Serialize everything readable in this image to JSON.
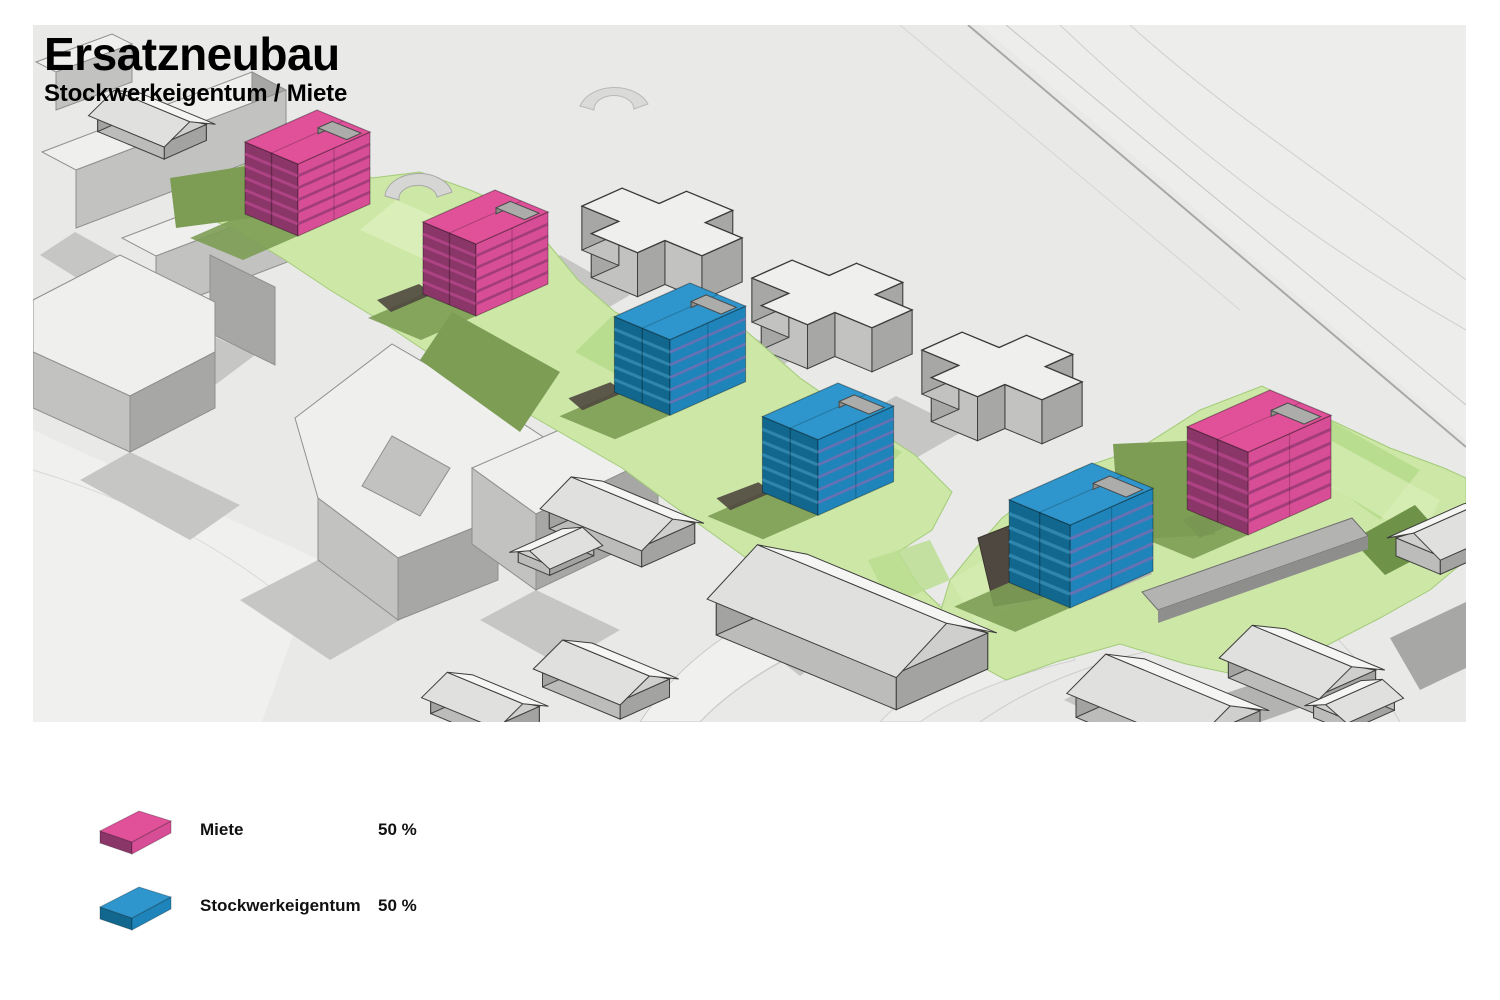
{
  "title": "Ersatzneubau",
  "subtitle": "Stockwerkeigentum / Miete",
  "legend": {
    "items": [
      {
        "id": "miete",
        "label": "Miete",
        "value": "50 %",
        "color_top": "#e0519a",
        "color_left": "#8b3668",
        "color_left_line": "#ad4384",
        "color_right": "#d84e96",
        "color_right_line": "#a23c7b"
      },
      {
        "id": "stockwerkeigentum",
        "label": "Stockwerkeigentum",
        "value": "50 %",
        "color_top": "#2e96cc",
        "color_left": "#12678f",
        "color_left_line": "#2f86ac",
        "color_right": "#1e84ba",
        "color_right_line": "#6472b4"
      }
    ]
  },
  "scene": {
    "towers": [
      {
        "id": "miete-1",
        "type": "miete"
      },
      {
        "id": "miete-2",
        "type": "miete"
      },
      {
        "id": "stockwerkeigentum-1",
        "type": "stockwerkeigentum"
      },
      {
        "id": "stockwerkeigentum-2",
        "type": "stockwerkeigentum"
      },
      {
        "id": "stockwerkeigentum-3",
        "type": "stockwerkeigentum"
      },
      {
        "id": "miete-3",
        "type": "miete"
      }
    ],
    "colors": {
      "terrain": "#e9e9e8",
      "terrain_light": "#f0f0ef",
      "terrain_pale": "#ededec",
      "shadow": "#c6c6c5",
      "green_light": "#cde7a6",
      "green_bright": "#d9eeb8",
      "green_mid": "#b9dd8e",
      "green_dark": "#7d9d55",
      "green_deep": "#6f9249",
      "pit": "#4f4840",
      "path_gray": "#b3b3b2",
      "path_dark": "#8e8e8d",
      "ctx_top": "#efefee",
      "ctx_se": "#c2c2c1",
      "ctx_sw": "#a7a7a6",
      "roof_slab_top": "#acacab",
      "roof_slab_side": "#8c8c8b"
    }
  }
}
